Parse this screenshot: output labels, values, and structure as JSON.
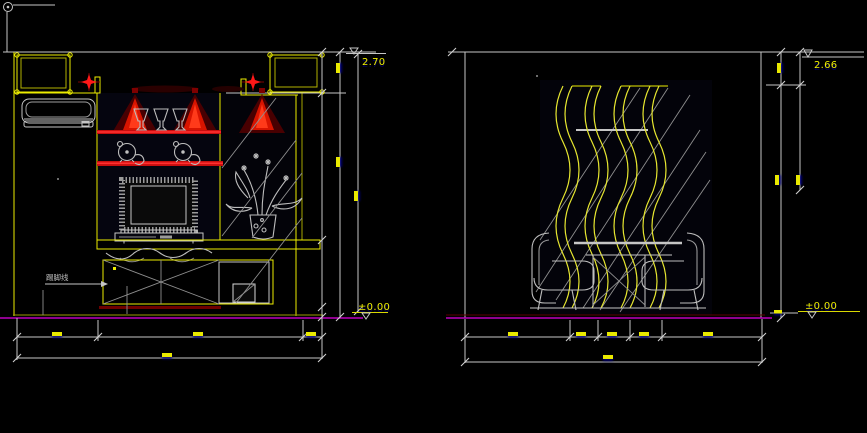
{
  "canvas": {
    "background": "#000000"
  },
  "colors": {
    "cad_yellow": "#EDED00",
    "cad_gray": "#C6C6C6",
    "light_red": "#E21212",
    "dark_red": "#6E0000",
    "floor_magenta": "#BE00BE",
    "dim_text_yellow": "#E9E900"
  },
  "left_elevation": {
    "description": "tv-wall-elevation",
    "levels": {
      "top": "2.70",
      "floor": "±0.00"
    },
    "skirting_label": "踢脚线"
  },
  "right_elevation": {
    "description": "dining-wall-elevation",
    "levels": {
      "top": "2.66",
      "floor": "±0.00"
    }
  }
}
